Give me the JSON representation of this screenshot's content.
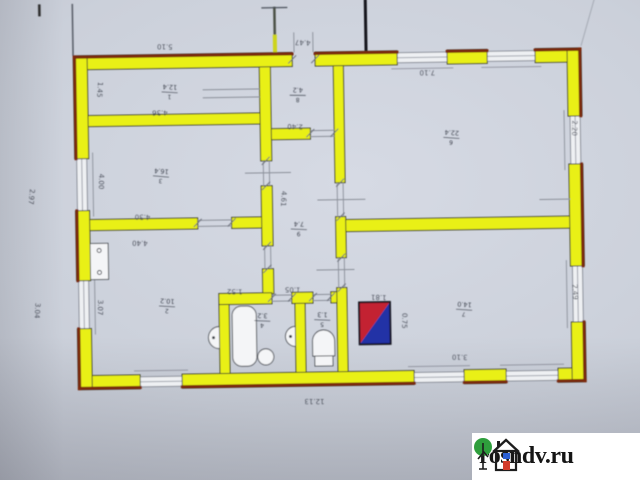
{
  "watermark": {
    "text": "rosndv.ru"
  },
  "plan": {
    "type": "floor-plan",
    "colors": {
      "walls": "#e9f017",
      "wall_edge": "#7c2a10",
      "windows": "#868b96",
      "paper": "#cbd0da",
      "ink": "#3e434e",
      "stove_red": "#c32433",
      "stove_blue": "#2030a6",
      "watermark_bg": "#ffffff",
      "logo_tree_green": "#2e9e3c",
      "logo_door_red": "#d23b2a",
      "logo_window_blue": "#2b5fd4"
    },
    "room_labels": [
      {
        "num": "1",
        "den": "12.4",
        "x": 172,
        "y": 90,
        "rot": 184
      },
      {
        "num": "8",
        "den": "4.2",
        "x": 300,
        "y": 95,
        "rot": 182
      },
      {
        "num": "6",
        "den": "22.4",
        "x": 453,
        "y": 140,
        "rot": 185
      },
      {
        "num": "3",
        "den": "16.4",
        "x": 162,
        "y": 174,
        "rot": 186
      },
      {
        "num": "9",
        "den": "7.4",
        "x": 299,
        "y": 229,
        "rot": 183
      },
      {
        "num": "2",
        "den": "10.2",
        "x": 166,
        "y": 304,
        "rot": 184
      },
      {
        "num": "4",
        "den": "3.2",
        "x": 261,
        "y": 320,
        "rot": 183
      },
      {
        "num": "5",
        "den": "1.3",
        "x": 321,
        "y": 320,
        "rot": 183
      },
      {
        "num": "7",
        "den": "14.0",
        "x": 463,
        "y": 312,
        "rot": 185
      }
    ],
    "dimensions": [
      {
        "text": "5.10",
        "x": 168,
        "y": 42,
        "rot": 182
      },
      {
        "text": "4.47",
        "x": 306,
        "y": 40,
        "rot": 183
      },
      {
        "text": "7.10",
        "x": 430,
        "y": 72,
        "rot": 181
      },
      {
        "text": "2.20",
        "x": 574,
        "y": 132,
        "rot": 92
      },
      {
        "text": "2.49",
        "x": 572,
        "y": 296,
        "rot": 88
      },
      {
        "text": "2.97",
        "x": 30,
        "y": 192,
        "rot": 96
      },
      {
        "text": "1.45",
        "x": 100,
        "y": 86,
        "rot": 95
      },
      {
        "text": "4.00",
        "x": 100,
        "y": 178,
        "rot": 92
      },
      {
        "text": "3.07",
        "x": 97,
        "y": 304,
        "rot": 92
      },
      {
        "text": "4.36",
        "x": 162,
        "y": 108,
        "rot": 181
      },
      {
        "text": "4.30",
        "x": 143,
        "y": 212,
        "rot": 182
      },
      {
        "text": "4.40",
        "x": 140,
        "y": 238,
        "rot": 182
      },
      {
        "text": "4.61",
        "x": 282,
        "y": 198,
        "rot": 94
      },
      {
        "text": "2.40",
        "x": 297,
        "y": 124,
        "rot": 183
      },
      {
        "text": "12.13",
        "x": 312,
        "y": 399,
        "rot": 181
      },
      {
        "text": "3.10",
        "x": 458,
        "y": 357,
        "rot": 182
      },
      {
        "text": "1.81",
        "x": 378,
        "y": 296,
        "rot": 183
      },
      {
        "text": "0.75",
        "x": 401,
        "y": 322,
        "rot": 92
      },
      {
        "text": "1.52",
        "x": 234,
        "y": 288,
        "rot": 182
      },
      {
        "text": "1.05",
        "x": 292,
        "y": 287,
        "rot": 182
      },
      {
        "text": "3.04",
        "x": 34,
        "y": 306,
        "rot": 95
      }
    ]
  }
}
